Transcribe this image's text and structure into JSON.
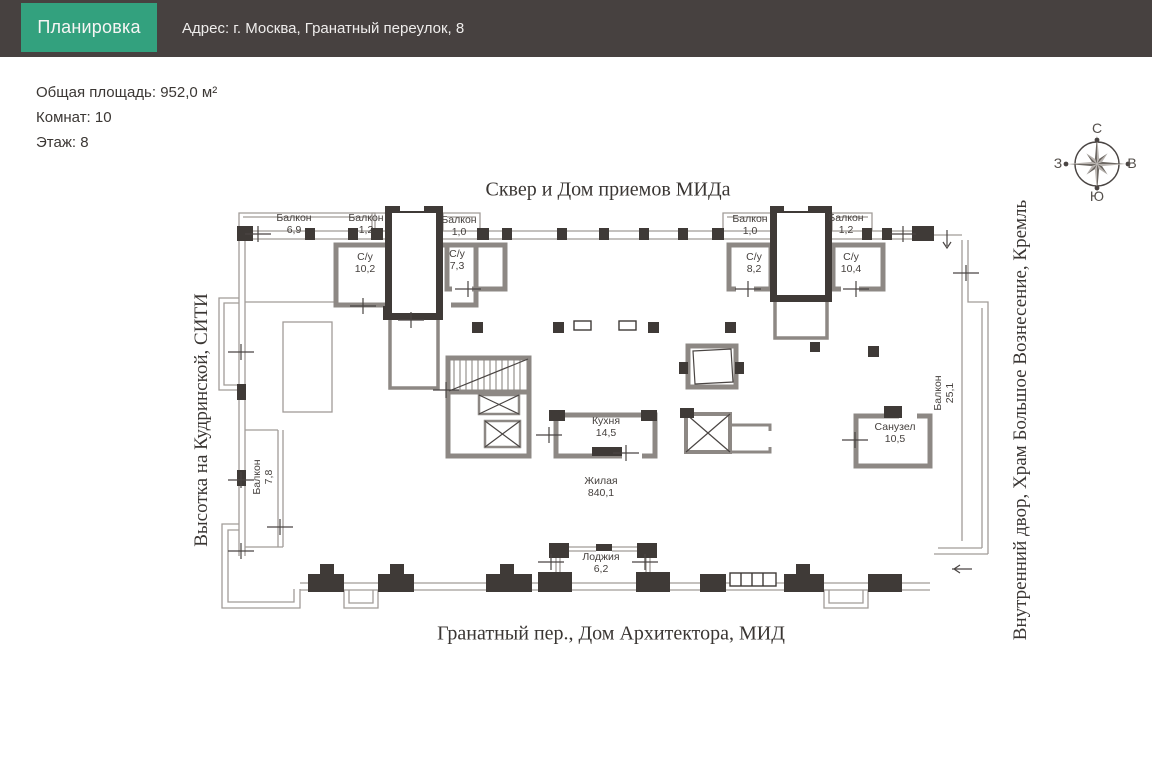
{
  "header": {
    "tab_label": "Планировка",
    "address": "Адрес: г. Москва, Гранатный переулок, 8"
  },
  "summary": {
    "total_area": "Общая площадь: 952,0 м²",
    "rooms_count": "Комнат: 10",
    "floor": "Этаж: 8"
  },
  "compass": {
    "north": "С",
    "east": "В",
    "south": "Ю",
    "west": "З"
  },
  "landmarks": {
    "top": "Сквер и Дом приемов МИДа",
    "bottom": "Гранатный пер., Дом Архитектора, МИД",
    "left": "Высотка на Кудринской, СИТИ",
    "right": "Внутренний двор, Храм Большое Вознесение, Кремль"
  },
  "rooms": {
    "balcony_69": {
      "name": "Балкон",
      "area": "6,9"
    },
    "balcony_12_left": {
      "name": "Балкон",
      "area": "1,2"
    },
    "balcony_10_left": {
      "name": "Балкон",
      "area": "1,0"
    },
    "su_102": {
      "name": "С/у",
      "area": "10,2"
    },
    "su_73": {
      "name": "С/у",
      "area": "7,3"
    },
    "balcony_10_right": {
      "name": "Балкон",
      "area": "1,0"
    },
    "su_82": {
      "name": "С/у",
      "area": "8,2"
    },
    "balcony_12_right": {
      "name": "Балкон",
      "area": "1,2"
    },
    "su_104": {
      "name": "С/у",
      "area": "10,4"
    },
    "kitchen": {
      "name": "Кухня",
      "area": "14,5"
    },
    "living": {
      "name": "Жилая",
      "area": "840,1"
    },
    "sanuzel": {
      "name": "Санузел",
      "area": "10,5"
    },
    "balcony_78": {
      "name": "Балкон",
      "area": "7,8"
    },
    "balcony_251": {
      "name": "Балкон",
      "area": "25,1"
    },
    "loggia": {
      "name": "Лоджия",
      "area": "6,2"
    }
  },
  "colors": {
    "header_bg": "#474140",
    "tab_green": "#33a17e",
    "wall_dark": "#3f3a37",
    "wall_gray": "#8d8884"
  }
}
